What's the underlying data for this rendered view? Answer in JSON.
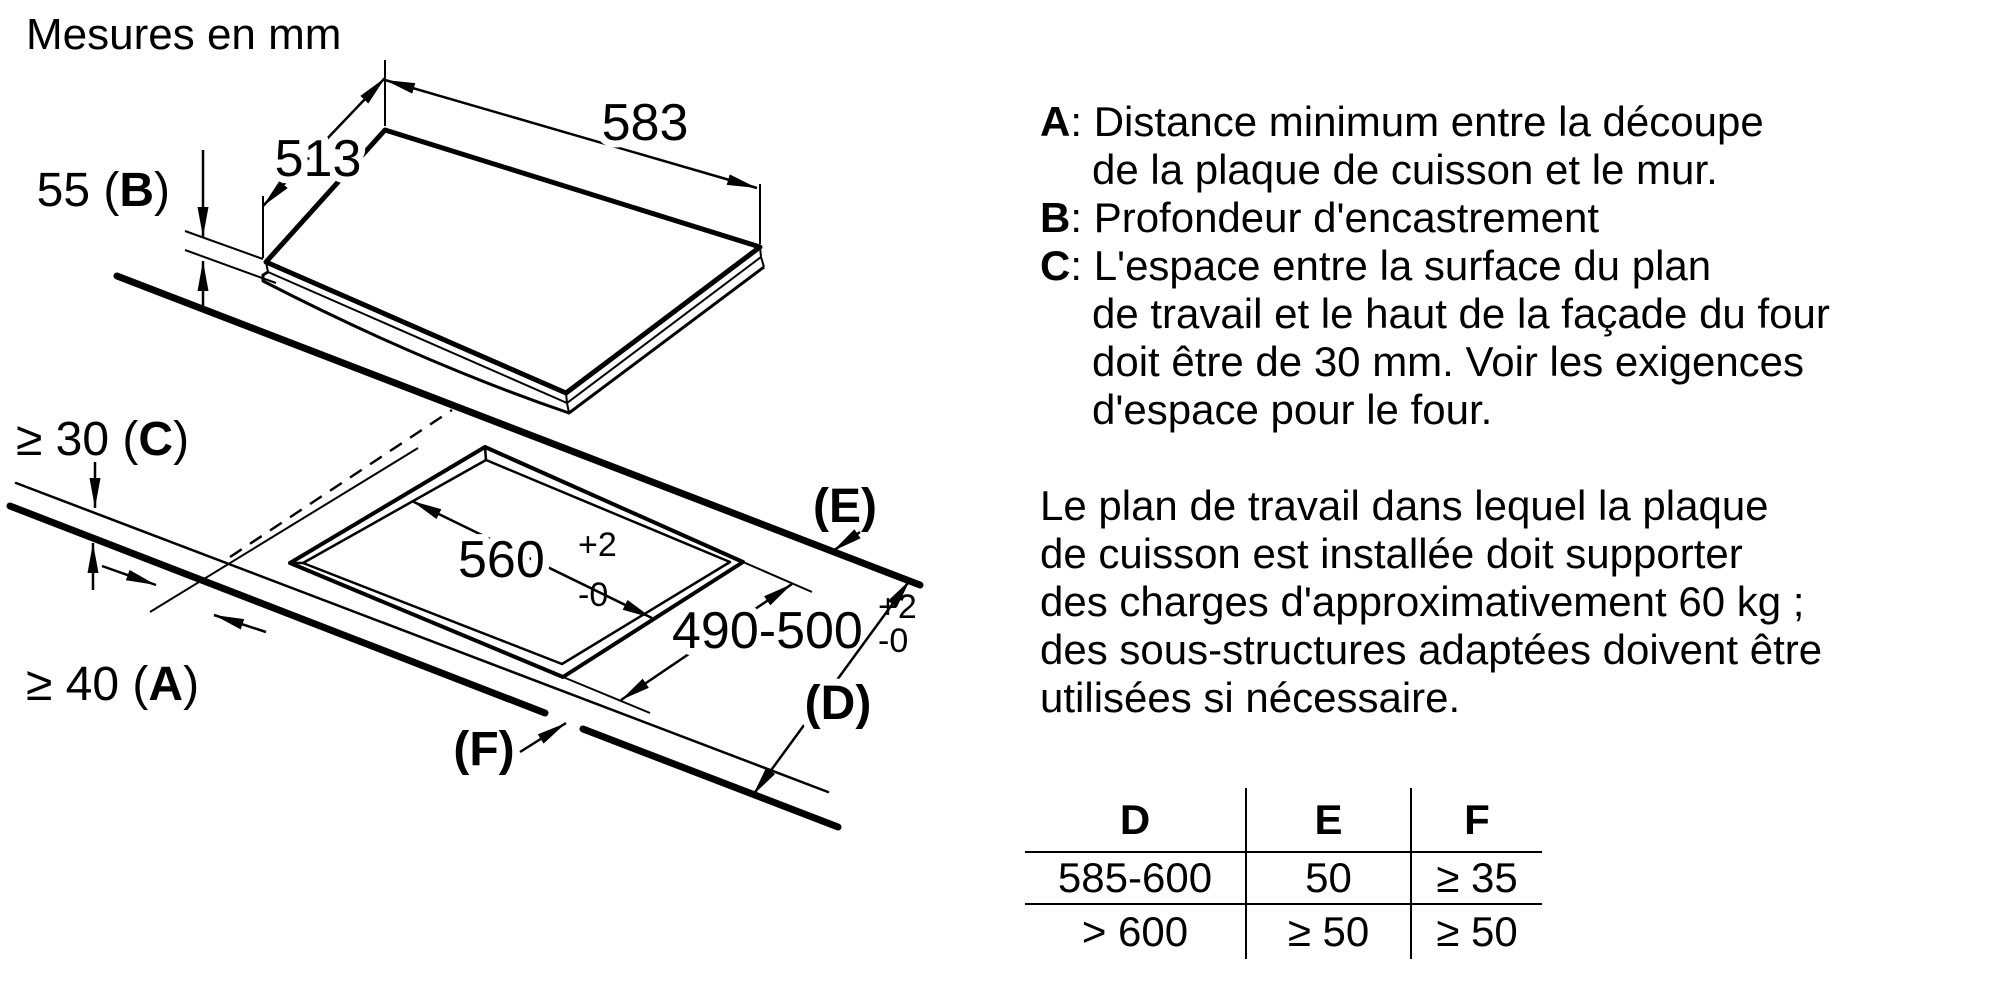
{
  "title": "Mesures en mm",
  "diagram": {
    "dim_513": "513",
    "dim_583": "583",
    "dim_55": {
      "pre": "55 (",
      "ref": "B",
      "post": ")"
    },
    "dim_30": {
      "pre": "≥ 30 (",
      "ref": "C",
      "post": ")"
    },
    "dim_40": {
      "pre": "≥ 40 (",
      "ref": "A",
      "post": ")"
    },
    "label_E": "(E)",
    "label_D": "(D)",
    "label_F": "(F)",
    "cutout_width": {
      "value": "560",
      "tol_plus": "+2",
      "tol_minus": "-0"
    },
    "cutout_depth": {
      "value": "490-500",
      "tol_plus": "+2",
      "tol_minus": "-0"
    }
  },
  "legend": {
    "items": [
      {
        "ref": "A",
        "sep": ": ",
        "lines": [
          "Distance minimum entre la découpe",
          "de la plaque de cuisson et le mur."
        ]
      },
      {
        "ref": "B",
        "sep": ": ",
        "lines": [
          "Profondeur d'encastrement"
        ]
      },
      {
        "ref": "C",
        "sep": ": ",
        "lines": [
          "L'espace entre la surface du plan",
          "de travail et le haut de la façade du four",
          "doit être de 30 mm. Voir les exigences",
          "d'espace pour le four."
        ]
      }
    ]
  },
  "paragraph": {
    "lines": [
      "Le plan de travail dans lequel la plaque",
      "de cuisson est installée doit supporter",
      "des charges d'approximativement 60 kg ;",
      "des sous-structures adaptées doivent être",
      "utilisées si nécessaire."
    ]
  },
  "table": {
    "headers": [
      "D",
      "E",
      "F"
    ],
    "rows": [
      [
        "585-600",
        "50",
        "≥ 35"
      ],
      [
        "> 600",
        "≥ 50",
        "≥ 50"
      ]
    ]
  }
}
